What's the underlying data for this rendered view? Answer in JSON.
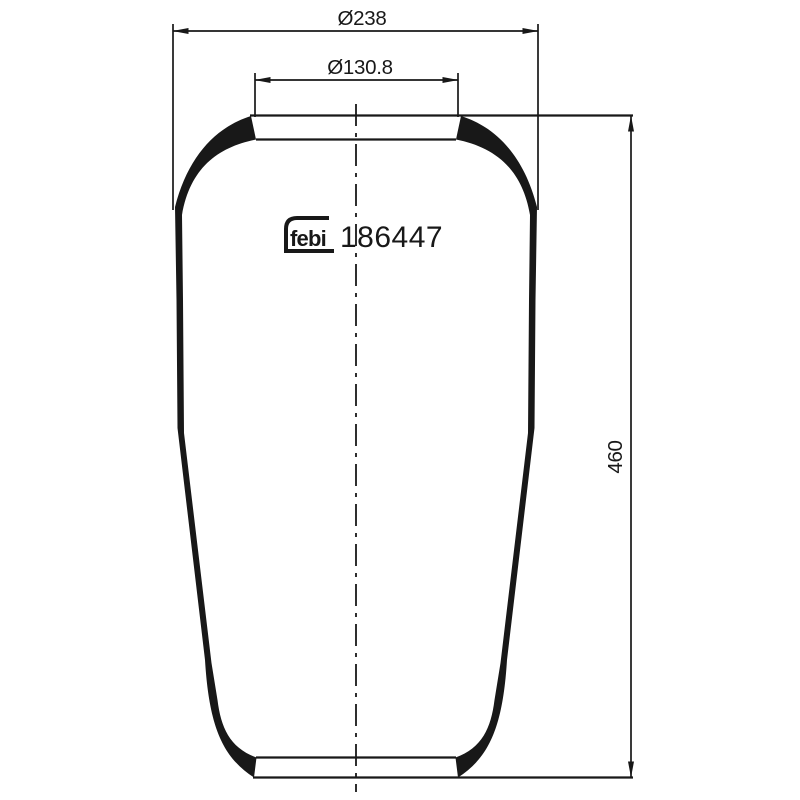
{
  "canvas": {
    "background": "#ffffff",
    "line_color": "#181818"
  },
  "logo": {
    "text": "febi"
  },
  "part": {
    "number": "186447"
  },
  "dimensions": {
    "outer_diameter_label": "Ø238",
    "neck_diameter_label": "Ø130.8",
    "height_label": "460"
  }
}
